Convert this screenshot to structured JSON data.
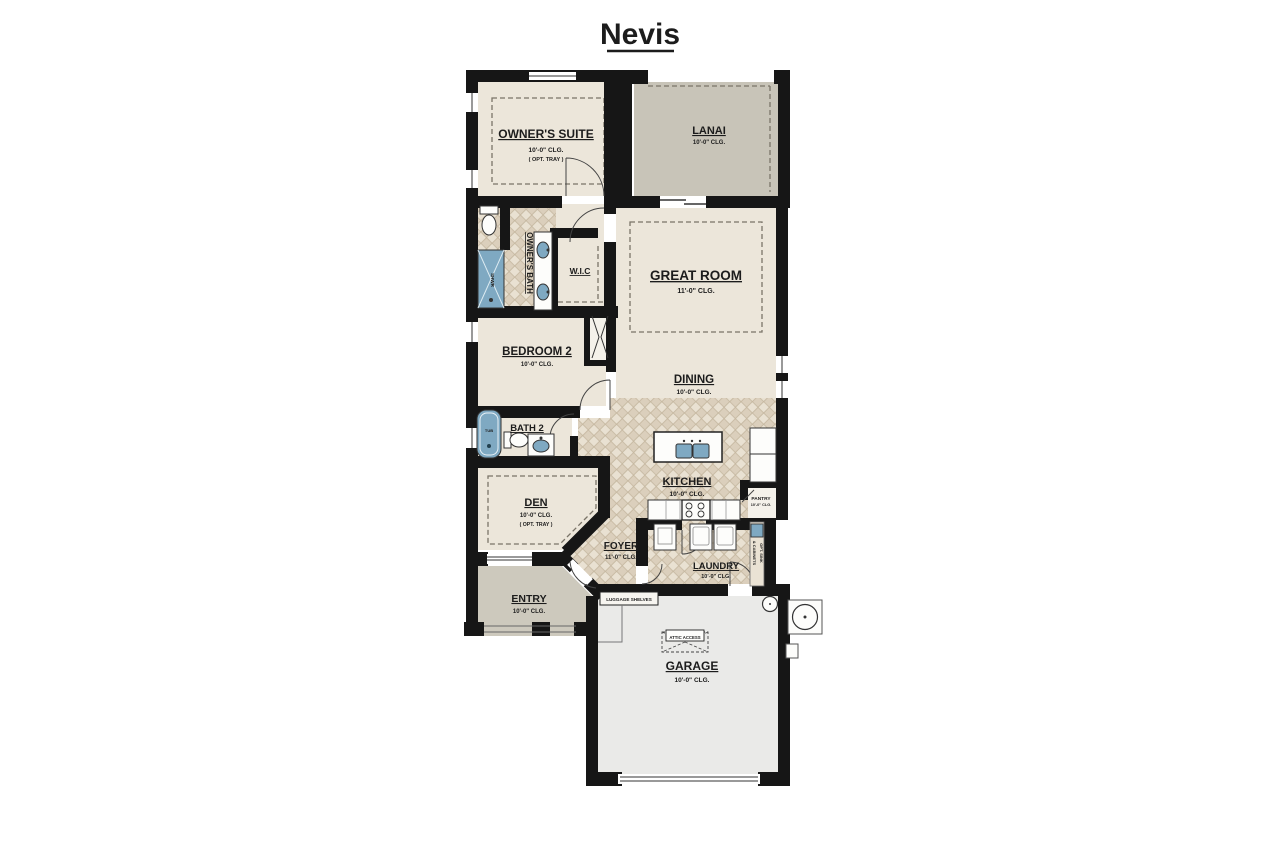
{
  "title": "Nevis",
  "rooms": {
    "owners_suite": {
      "name": "OWNER'S SUITE",
      "clg": "10'-0\" CLG.",
      "note": "( OPT. TRAY )"
    },
    "lanai": {
      "name": "LANAI",
      "clg": "10'-0\" CLG."
    },
    "great_room": {
      "name": "GREAT ROOM",
      "clg": "11'-0\" CLG."
    },
    "dining": {
      "name": "DINING",
      "clg": "10'-0\" CLG."
    },
    "owners_bath": {
      "name": "OWNER'S BATH"
    },
    "wic": {
      "name": "W.I.C"
    },
    "bedroom2": {
      "name": "BEDROOM 2",
      "clg": "10'-0\" CLG."
    },
    "bath2": {
      "name": "BATH 2"
    },
    "kitchen": {
      "name": "KITCHEN",
      "clg": "10'-0\" CLG."
    },
    "pantry": {
      "name": "PANTRY",
      "clg": "10'-0\" CLG."
    },
    "den": {
      "name": "DEN",
      "clg": "10'-0\" CLG.",
      "note": "( OPT. TRAY )"
    },
    "foyer": {
      "name": "FOYER",
      "clg": "11'-0\" CLG."
    },
    "laundry": {
      "name": "LAUNDRY",
      "clg": "10'-0\" CLG."
    },
    "entry": {
      "name": "ENTRY",
      "clg": "10'-0\" CLG."
    },
    "garage": {
      "name": "GARAGE",
      "clg": "10'-0\" CLG."
    }
  },
  "fixtures": {
    "tub": "TUB",
    "shower": "SHWR",
    "luggage_shelves": "LUGGAGE SHELVES",
    "attic_access": "ATTIC ACCESS",
    "opt_sink_line1": "OPT. SINK",
    "opt_sink_line2": "& CABINETS"
  },
  "colors": {
    "wall": "#161616",
    "room_beige": "#ece6da",
    "tile_light": "#e9e1d2",
    "tile_dark": "#dbcfbc",
    "lanai_gray": "#c8c4b8",
    "entry_gray": "#cdc9bd",
    "garage_gray": "#eaeae8",
    "fixture_blue": "#7fa9c2"
  }
}
